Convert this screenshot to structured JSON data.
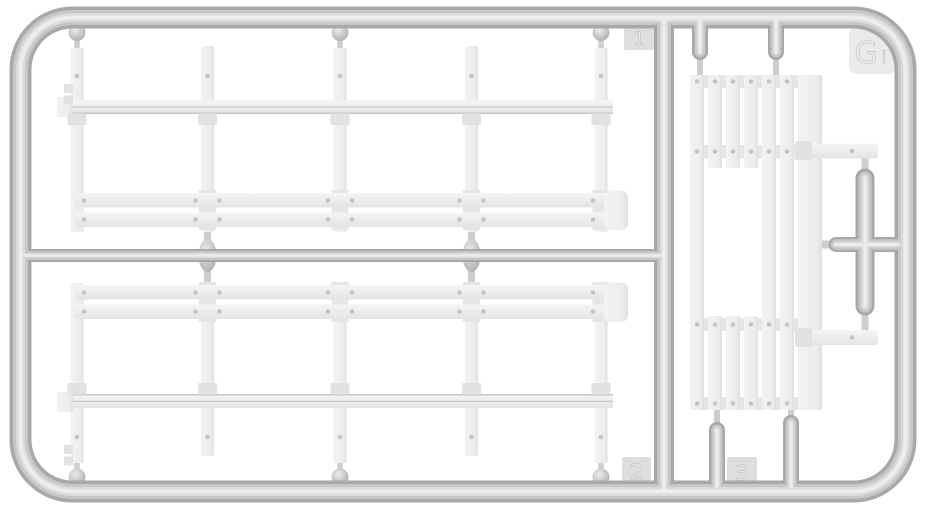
{
  "scene": {
    "type": "model-kit-sprue",
    "description": "Light gray injection-molded styrene sprue carrying flatbed side panels with stake posts, plank walls and a cross runner",
    "background_color": "#ffffff"
  },
  "labels": {
    "corner_letter_main": "G",
    "corner_letter_sub": "i",
    "gate_number_1": "1",
    "gate_number_2": "2",
    "gate_number_3": "3"
  },
  "colors": {
    "runner_base": "#a6a8aa",
    "runner_mid": "#c5c7c9",
    "runner_light": "#d9dbdc",
    "runner_highlight": "#eceeee",
    "part_top": "#f4f5f6",
    "part_bottom": "#e2e4e5",
    "part_left": "#f2f3f4",
    "part_right": "#dddfe1",
    "part_shadow": "#e0e2e4",
    "batten": "#e4e6e7",
    "seam": "#c4c6c8",
    "rivet": "#c2c4c6",
    "stub": "#ccced0",
    "ball_center": "#eaeced",
    "ball_edge": "#a8aaac",
    "tab_face": "#dcdee0",
    "tab_face_light": "#e8eaeb",
    "emboss_fill": "#e9ebec",
    "emboss_stroke": "#c2c4c6"
  }
}
